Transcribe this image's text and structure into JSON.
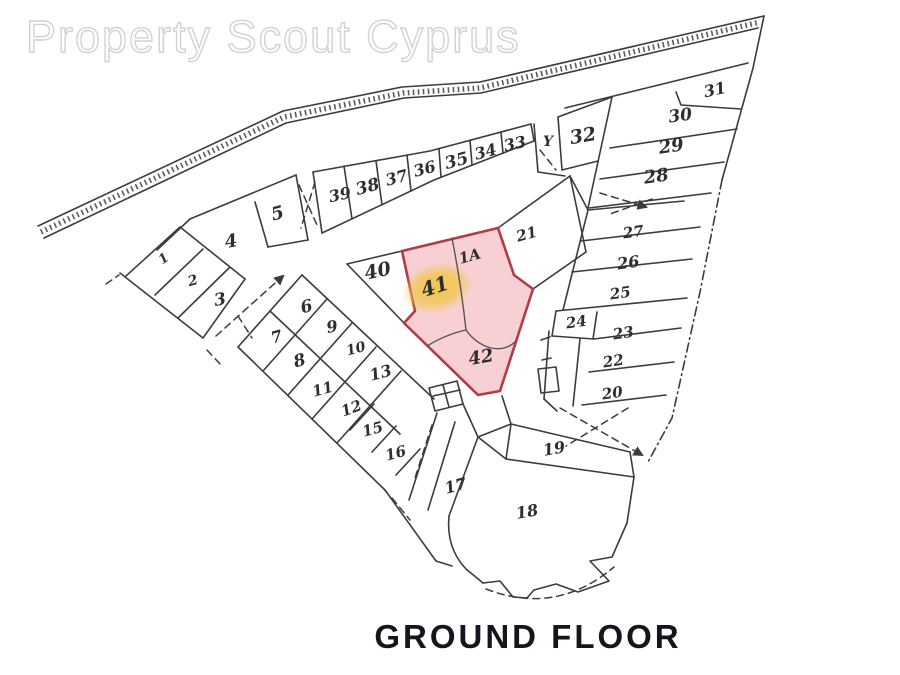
{
  "watermark": {
    "text": "Property Scout Cyprus"
  },
  "caption": {
    "text": "GROUND FLOOR"
  },
  "colors": {
    "ink": "#3c3c3c",
    "watermark_outline": "#d2d2d2",
    "highlight_fill": "#f7c8cb",
    "highlight_border": "#b13b46",
    "glow": "#f0c64a",
    "highlight_label": "#7c3a2e",
    "caption_color": "#15151d"
  },
  "plan": {
    "title": "Ground floor site plan with plot 41 highlighted",
    "highlighted_labels": [
      "41"
    ],
    "highlighted_area_labels": [
      "41",
      "1A",
      "42"
    ],
    "labels": [
      {
        "t": "1",
        "x": 166,
        "y": 262,
        "r": -35,
        "s": 13
      },
      {
        "t": "2",
        "x": 194,
        "y": 285,
        "r": -15,
        "s": 14
      },
      {
        "t": "3",
        "x": 221,
        "y": 305,
        "r": -10,
        "s": 17
      },
      {
        "t": "4",
        "x": 232,
        "y": 247,
        "r": -10,
        "s": 18
      },
      {
        "t": "5",
        "x": 279,
        "y": 219,
        "r": -15,
        "s": 18
      },
      {
        "t": "6",
        "x": 308,
        "y": 312,
        "r": -15,
        "s": 17
      },
      {
        "t": "7",
        "x": 278,
        "y": 342,
        "r": -15,
        "s": 16
      },
      {
        "t": "8",
        "x": 301,
        "y": 366,
        "r": -15,
        "s": 17
      },
      {
        "t": "9",
        "x": 333,
        "y": 332,
        "r": -10,
        "s": 16
      },
      {
        "t": "10",
        "x": 357,
        "y": 353,
        "r": -15,
        "s": 14
      },
      {
        "t": "11",
        "x": 324,
        "y": 394,
        "r": -15,
        "s": 15
      },
      {
        "t": "12",
        "x": 353,
        "y": 413,
        "r": -20,
        "s": 15
      },
      {
        "t": "13",
        "x": 382,
        "y": 378,
        "r": -15,
        "s": 16
      },
      {
        "t": "15",
        "x": 374,
        "y": 434,
        "r": -15,
        "s": 15
      },
      {
        "t": "16",
        "x": 397,
        "y": 458,
        "r": -15,
        "s": 15
      },
      {
        "t": "17",
        "x": 457,
        "y": 491,
        "r": -15,
        "s": 16
      },
      {
        "t": "18",
        "x": 528,
        "y": 517,
        "r": -10,
        "s": 16
      },
      {
        "t": "19",
        "x": 555,
        "y": 454,
        "r": -10,
        "s": 16
      },
      {
        "t": "20",
        "x": 613,
        "y": 398,
        "r": -8,
        "s": 15
      },
      {
        "t": "21",
        "x": 528,
        "y": 239,
        "r": -15,
        "s": 15
      },
      {
        "t": "22",
        "x": 614,
        "y": 366,
        "r": -8,
        "s": 15
      },
      {
        "t": "23",
        "x": 624,
        "y": 338,
        "r": -8,
        "s": 15
      },
      {
        "t": "24",
        "x": 577,
        "y": 327,
        "r": -8,
        "s": 15
      },
      {
        "t": "25",
        "x": 621,
        "y": 298,
        "r": -8,
        "s": 15
      },
      {
        "t": "26",
        "x": 629,
        "y": 268,
        "r": -8,
        "s": 16
      },
      {
        "t": "27",
        "x": 634,
        "y": 237,
        "r": -8,
        "s": 15
      },
      {
        "t": "28",
        "x": 657,
        "y": 182,
        "r": -8,
        "s": 18
      },
      {
        "t": "29",
        "x": 672,
        "y": 152,
        "r": -8,
        "s": 18
      },
      {
        "t": "30",
        "x": 681,
        "y": 121,
        "r": -8,
        "s": 17
      },
      {
        "t": "31",
        "x": 716,
        "y": 95,
        "r": -12,
        "s": 16
      },
      {
        "t": "32",
        "x": 584,
        "y": 142,
        "r": -10,
        "s": 19
      },
      {
        "t": "33",
        "x": 516,
        "y": 149,
        "r": -12,
        "s": 16
      },
      {
        "t": "34",
        "x": 487,
        "y": 157,
        "r": -15,
        "s": 16
      },
      {
        "t": "35",
        "x": 458,
        "y": 166,
        "r": -15,
        "s": 17
      },
      {
        "t": "36",
        "x": 426,
        "y": 174,
        "r": -15,
        "s": 16
      },
      {
        "t": "37",
        "x": 398,
        "y": 183,
        "r": -15,
        "s": 16
      },
      {
        "t": "38",
        "x": 369,
        "y": 192,
        "r": -15,
        "s": 17
      },
      {
        "t": "39",
        "x": 341,
        "y": 200,
        "r": -12,
        "s": 16
      },
      {
        "t": "40",
        "x": 379,
        "y": 277,
        "r": -12,
        "s": 19
      },
      {
        "t": "1A",
        "x": 471,
        "y": 261,
        "r": -15,
        "s": 15
      },
      {
        "t": "41",
        "x": 437,
        "y": 293,
        "r": -18,
        "s": 20
      },
      {
        "t": "42",
        "x": 482,
        "y": 363,
        "r": -10,
        "s": 18
      }
    ],
    "marks": [
      {
        "t": "Y",
        "x": 548,
        "y": 146,
        "r": 0,
        "s": 14
      }
    ]
  }
}
